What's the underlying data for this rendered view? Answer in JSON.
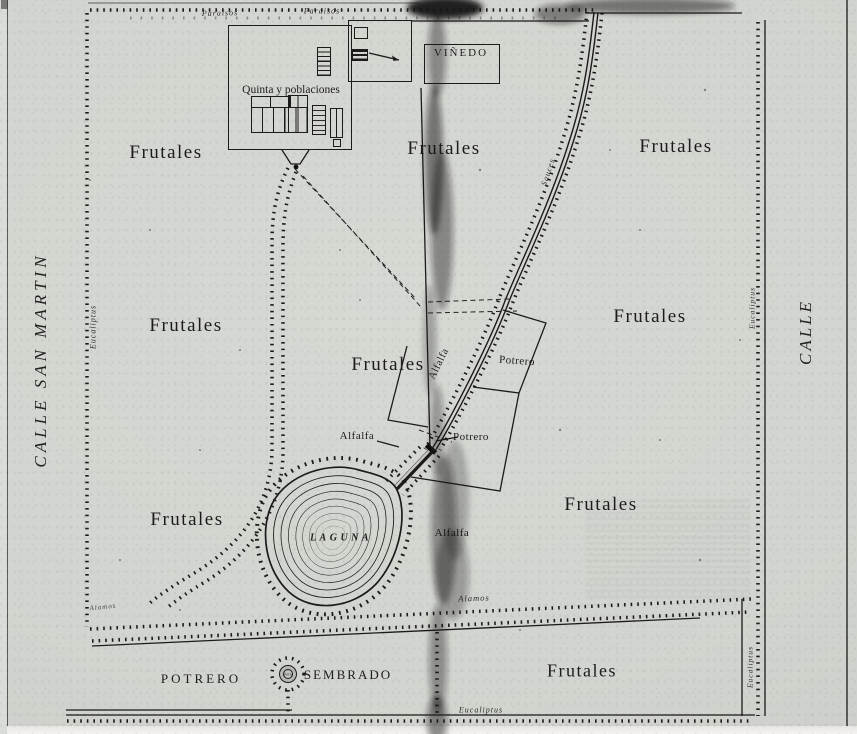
{
  "colors": {
    "ink": "#1b1b1b",
    "paper": "#d3d5d1"
  },
  "streets": {
    "left": "CALLE SAN MARTIN",
    "right": "CALLE"
  },
  "compound": {
    "quinta": "Quinta y poblaciones",
    "vinedo": "VIÑEDO"
  },
  "frutales_labels": [
    "Frutales",
    "Frutales",
    "Frutales",
    "Frutales",
    "Frutales",
    "Frutales",
    "Frutales",
    "Frutales",
    "Frutales"
  ],
  "fields": {
    "alfalfa_road": "Alfalfa",
    "alfalfa_mid": "Alfalfa",
    "alfalfa_south": "Alfalfa",
    "potrero_upper": "Potrero",
    "potrero_lower": "Potrero",
    "potrero_strip": "POTRERO",
    "sembrado": "SEMBRADO",
    "laguna": "LAGUNA",
    "noria": "Noria"
  },
  "tree_rows": {
    "paraisos_a": "Paraisos",
    "paraisos_b": "Paraisos",
    "eucaliptus_left": "Eucaliptus",
    "eucaliptus_right_upper": "Eucaliptus",
    "eucaliptus_right_lower": "Eucaliptus",
    "eucaliptus_bottom": "Eucaliptus",
    "sauces": "Sauces",
    "alamos_mid": "Alamos",
    "alamos_left": "Alamos"
  }
}
